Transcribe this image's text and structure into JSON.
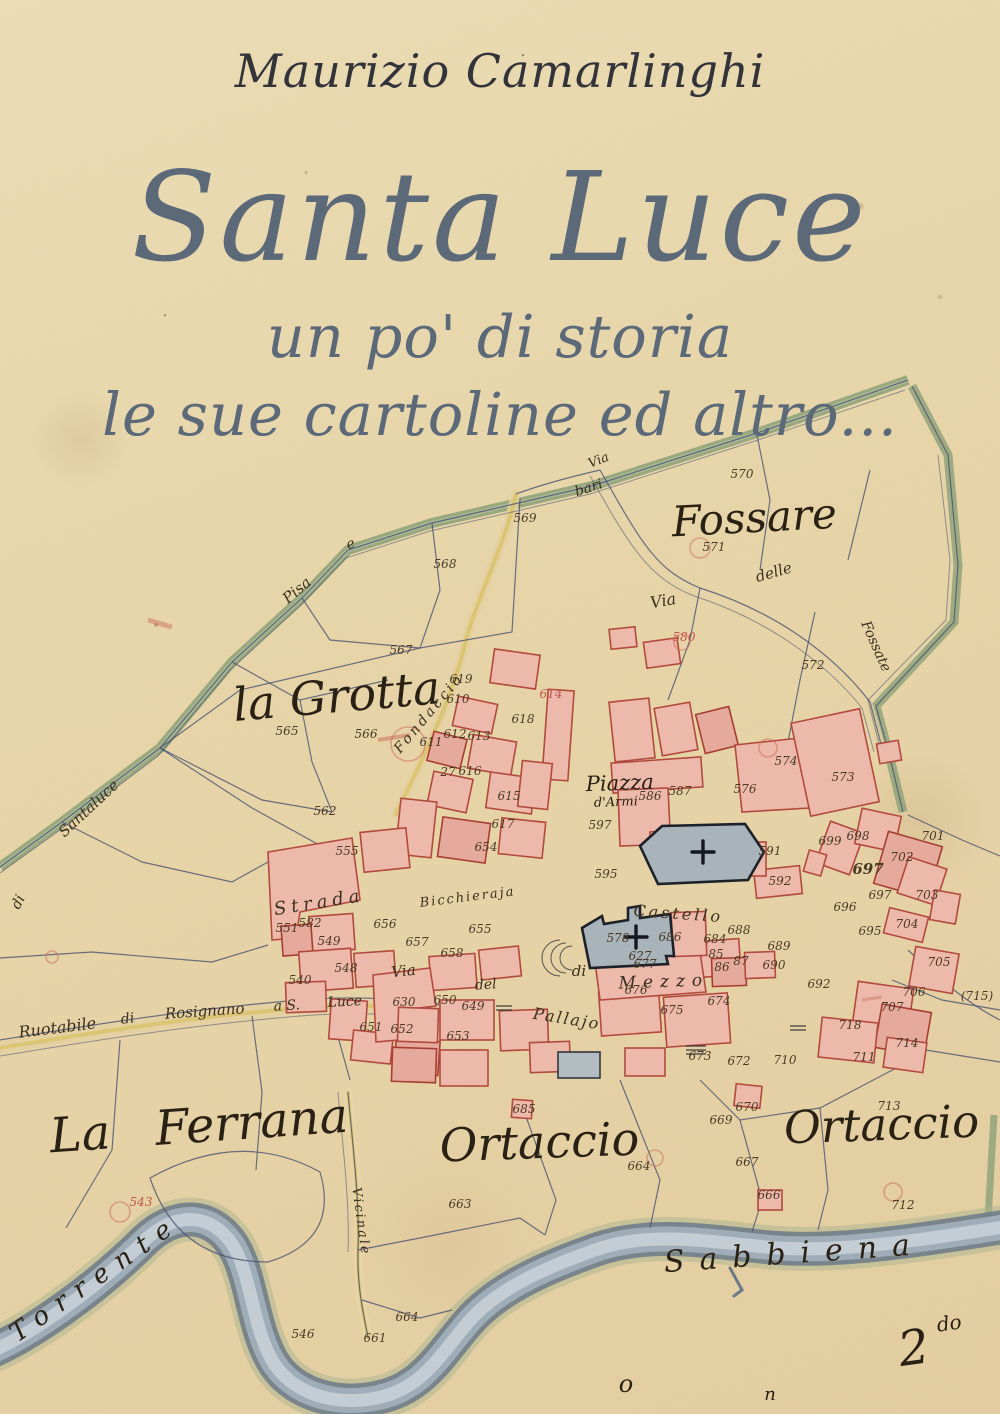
{
  "cover": {
    "author": "Maurizio Camarlinghi",
    "title": "Santa Luce",
    "subtitle1": "un po' di storia",
    "subtitle2": "le sue cartoline ed altro...",
    "colors": {
      "title_blue": "#5c6979",
      "author_ink": "#33343a",
      "paper": "#e9d7aa"
    }
  },
  "map": {
    "colors": {
      "ink_line": "#45506f",
      "building_fill": "#ecb9ab",
      "building_stroke": "#b24a3e",
      "church_fill": "#a9b3ba",
      "boundary_green": "#8ca078",
      "road_yellow": "#d9c267",
      "river_dark": "#6c7a88",
      "river_light": "#c6cfd4"
    },
    "region_labels": [
      {
        "name": "label-fossare",
        "text": "Fossare",
        "x": 755,
        "y": 532,
        "size": 42,
        "rot": -3
      },
      {
        "name": "label-la-grotta",
        "text": "la Grotta",
        "x": 338,
        "y": 712,
        "size": 46,
        "rot": -5
      },
      {
        "name": "label-la-ferrana",
        "text": "La Ferrana",
        "x": 200,
        "y": 1142,
        "size": 48,
        "rot": -4,
        "ws": 30
      },
      {
        "name": "label-ortaccio-west",
        "text": "Ortaccio",
        "x": 540,
        "y": 1158,
        "size": 46,
        "rot": -2
      },
      {
        "name": "label-ortaccio-east",
        "text": "Ortaccio",
        "x": 882,
        "y": 1140,
        "size": 45,
        "rot": -2
      },
      {
        "name": "label-river-sabbiena",
        "text": "Sabbiena",
        "x": 795,
        "y": 1263,
        "size": 30,
        "rot": -4,
        "ls": 15
      },
      {
        "name": "label-river-torrente",
        "text": "Torrente",
        "x": 100,
        "y": 1285,
        "size": 26,
        "rot": -35,
        "ls": 11
      },
      {
        "name": "label-piazza",
        "text": "Piazza",
        "x": 620,
        "y": 790,
        "size": 21,
        "rot": -2
      },
      {
        "name": "label-piazza-2",
        "text": "d'Armi",
        "x": 616,
        "y": 806,
        "size": 13,
        "rot": -2
      },
      {
        "name": "label-quarter-mark",
        "text": "2",
        "x": 916,
        "y": 1364,
        "size": 48,
        "rot": -8
      },
      {
        "name": "label-quarter-mark-sup",
        "text": "do",
        "x": 950,
        "y": 1330,
        "size": 20,
        "rot": -8
      },
      {
        "name": "label-mark-o",
        "text": "o",
        "x": 626,
        "y": 1392,
        "size": 24,
        "rot": 0
      },
      {
        "name": "label-mark-n",
        "text": "n",
        "x": 770,
        "y": 1400,
        "size": 18,
        "rot": 0
      }
    ],
    "street_labels": [
      {
        "name": "street-via-top",
        "text": "Via",
        "x": 600,
        "y": 464,
        "size": 13,
        "rot": -22
      },
      {
        "name": "street-bari",
        "text": "bari",
        "x": 590,
        "y": 492,
        "size": 14,
        "rot": -18
      },
      {
        "name": "street-e",
        "text": "e",
        "x": 352,
        "y": 548,
        "size": 14,
        "rot": -20
      },
      {
        "name": "street-pisa",
        "text": "Pisa",
        "x": 300,
        "y": 594,
        "size": 15,
        "rot": -40
      },
      {
        "name": "street-santaluce",
        "text": "Santaluce",
        "x": 92,
        "y": 812,
        "size": 15,
        "rot": -43
      },
      {
        "name": "street-di-left",
        "text": "di",
        "x": 22,
        "y": 904,
        "size": 14,
        "rot": -62
      },
      {
        "name": "street-via-ne",
        "text": "Via",
        "x": 664,
        "y": 606,
        "size": 16,
        "rot": -10
      },
      {
        "name": "street-delle",
        "text": "delle",
        "x": 775,
        "y": 577,
        "size": 15,
        "rot": -16
      },
      {
        "name": "street-fossate",
        "text": "Fossate",
        "x": 872,
        "y": 648,
        "size": 14,
        "rot": 66
      },
      {
        "name": "street-fondaccio",
        "text": "Fondaccio",
        "x": 432,
        "y": 716,
        "size": 14,
        "rot": -50,
        "ls": 3
      },
      {
        "name": "street-strada",
        "text": "Strada",
        "x": 320,
        "y": 908,
        "size": 18,
        "rot": -9,
        "ls": 5
      },
      {
        "name": "street-bicchieraja",
        "text": "Bicchieraja",
        "x": 468,
        "y": 901,
        "size": 13,
        "rot": -7,
        "ls": 2
      },
      {
        "name": "street-castello",
        "text": "Castello",
        "x": 678,
        "y": 919,
        "size": 16,
        "rot": 4,
        "ls": 3
      },
      {
        "name": "street-di-mezzo-1",
        "text": "di",
        "x": 579,
        "y": 976,
        "size": 15,
        "rot": 0
      },
      {
        "name": "street-di-mezzo-2",
        "text": "Mezzo",
        "x": 664,
        "y": 987,
        "size": 17,
        "rot": -2,
        "ls": 7
      },
      {
        "name": "street-via-pallajo-1",
        "text": "Via",
        "x": 404,
        "y": 976,
        "size": 15,
        "rot": -6
      },
      {
        "name": "street-via-pallajo-2",
        "text": "del",
        "x": 486,
        "y": 989,
        "size": 14,
        "rot": -4
      },
      {
        "name": "street-via-pallajo-3",
        "text": "Pallajo",
        "x": 566,
        "y": 1024,
        "size": 16,
        "rot": 9,
        "ls": 2
      },
      {
        "name": "street-ruotabile",
        "text": "Ruotabile",
        "x": 58,
        "y": 1033,
        "size": 16,
        "rot": -7
      },
      {
        "name": "street-ruotabile-di",
        "text": "di",
        "x": 128,
        "y": 1023,
        "size": 14,
        "rot": -6
      },
      {
        "name": "street-rosignano",
        "text": "Rosignano",
        "x": 205,
        "y": 1016,
        "size": 15,
        "rot": -4
      },
      {
        "name": "street-a-s",
        "text": "a S.",
        "x": 287,
        "y": 1010,
        "size": 14,
        "rot": -3
      },
      {
        "name": "street-luce",
        "text": "Luce",
        "x": 345,
        "y": 1006,
        "size": 14,
        "rot": -3
      },
      {
        "name": "street-vicinale",
        "text": "Vicinale",
        "x": 357,
        "y": 1222,
        "size": 13,
        "rot": 82,
        "ls": 2
      }
    ],
    "parcel_numbers": [
      {
        "n": "570",
        "x": 742,
        "y": 478
      },
      {
        "n": "571",
        "x": 714,
        "y": 551
      },
      {
        "n": "580",
        "x": 684,
        "y": 641,
        "red": true
      },
      {
        "n": "572",
        "x": 813,
        "y": 669
      },
      {
        "n": "573",
        "x": 843,
        "y": 781
      },
      {
        "n": "574",
        "x": 786,
        "y": 765
      },
      {
        "n": "565",
        "x": 287,
        "y": 735
      },
      {
        "n": "566",
        "x": 366,
        "y": 738
      },
      {
        "n": "567",
        "x": 401,
        "y": 654
      },
      {
        "n": "562",
        "x": 325,
        "y": 815
      },
      {
        "n": "568",
        "x": 445,
        "y": 568
      },
      {
        "n": "569",
        "x": 525,
        "y": 522
      },
      {
        "n": "543",
        "x": 141,
        "y": 1206,
        "red": true
      },
      {
        "n": "546",
        "x": 303,
        "y": 1338
      },
      {
        "n": "661",
        "x": 375,
        "y": 1342
      },
      {
        "n": "663",
        "x": 460,
        "y": 1208
      },
      {
        "n": "664",
        "x": 407,
        "y": 1321
      },
      {
        "n": "664",
        "x": 639,
        "y": 1170
      },
      {
        "n": "666",
        "x": 769,
        "y": 1199
      },
      {
        "n": "667",
        "x": 747,
        "y": 1166
      },
      {
        "n": "669",
        "x": 721,
        "y": 1124
      },
      {
        "n": "670",
        "x": 747,
        "y": 1111
      },
      {
        "n": "685",
        "x": 524,
        "y": 1113
      },
      {
        "n": "713",
        "x": 889,
        "y": 1110
      },
      {
        "n": "712",
        "x": 903,
        "y": 1209
      },
      {
        "n": "711",
        "x": 864,
        "y": 1061
      },
      {
        "n": "714",
        "x": 907,
        "y": 1047
      },
      {
        "n": "(715)",
        "x": 977,
        "y": 1000
      },
      {
        "n": "718",
        "x": 850,
        "y": 1029
      },
      {
        "n": "707",
        "x": 892,
        "y": 1011
      },
      {
        "n": "706",
        "x": 914,
        "y": 996
      },
      {
        "n": "705",
        "x": 939,
        "y": 966
      },
      {
        "n": "704",
        "x": 907,
        "y": 928
      },
      {
        "n": "695",
        "x": 870,
        "y": 935
      },
      {
        "n": "696",
        "x": 845,
        "y": 911
      },
      {
        "n": "703",
        "x": 927,
        "y": 899
      },
      {
        "n": "697",
        "x": 868,
        "y": 874,
        "b": true,
        "size": 15
      },
      {
        "n": "697",
        "x": 880,
        "y": 899
      },
      {
        "n": "698",
        "x": 858,
        "y": 840
      },
      {
        "n": "699",
        "x": 830,
        "y": 845
      },
      {
        "n": "701",
        "x": 933,
        "y": 840
      },
      {
        "n": "702",
        "x": 902,
        "y": 861
      },
      {
        "n": "692",
        "x": 819,
        "y": 988
      },
      {
        "n": "690",
        "x": 774,
        "y": 969
      },
      {
        "n": "689",
        "x": 779,
        "y": 950
      },
      {
        "n": "688",
        "x": 739,
        "y": 934
      },
      {
        "n": "684",
        "x": 715,
        "y": 943
      },
      {
        "n": "686",
        "x": 670,
        "y": 941
      },
      {
        "n": "677",
        "x": 645,
        "y": 968
      },
      {
        "n": "578",
        "x": 618,
        "y": 942
      },
      {
        "n": "676",
        "x": 636,
        "y": 994
      },
      {
        "n": "675",
        "x": 672,
        "y": 1014
      },
      {
        "n": "674",
        "x": 719,
        "y": 1005
      },
      {
        "n": "673",
        "x": 700,
        "y": 1060
      },
      {
        "n": "672",
        "x": 739,
        "y": 1065
      },
      {
        "n": "710",
        "x": 785,
        "y": 1064
      },
      {
        "n": "85",
        "x": 716,
        "y": 958
      },
      {
        "n": "86",
        "x": 722,
        "y": 971
      },
      {
        "n": "87",
        "x": 741,
        "y": 965
      },
      {
        "n": "592",
        "x": 780,
        "y": 885
      },
      {
        "n": "595",
        "x": 606,
        "y": 878
      },
      {
        "n": "597",
        "x": 600,
        "y": 829
      },
      {
        "n": "587",
        "x": 680,
        "y": 795
      },
      {
        "n": "586",
        "x": 650,
        "y": 800
      },
      {
        "n": "576",
        "x": 745,
        "y": 793
      },
      {
        "n": "591",
        "x": 770,
        "y": 855
      },
      {
        "n": "555",
        "x": 347,
        "y": 855
      },
      {
        "n": "582",
        "x": 310,
        "y": 927
      },
      {
        "n": "551",
        "x": 287,
        "y": 932
      },
      {
        "n": "549",
        "x": 329,
        "y": 945
      },
      {
        "n": "548",
        "x": 346,
        "y": 972
      },
      {
        "n": "540",
        "x": 300,
        "y": 984
      },
      {
        "n": "630",
        "x": 404,
        "y": 1006
      },
      {
        "n": "650",
        "x": 445,
        "y": 1004
      },
      {
        "n": "649",
        "x": 473,
        "y": 1010
      },
      {
        "n": "651",
        "x": 371,
        "y": 1031
      },
      {
        "n": "652",
        "x": 402,
        "y": 1033
      },
      {
        "n": "653",
        "x": 458,
        "y": 1040
      },
      {
        "n": "654",
        "x": 486,
        "y": 851
      },
      {
        "n": "655",
        "x": 480,
        "y": 933
      },
      {
        "n": "656",
        "x": 385,
        "y": 928
      },
      {
        "n": "657",
        "x": 417,
        "y": 946
      },
      {
        "n": "658",
        "x": 452,
        "y": 957
      },
      {
        "n": "610",
        "x": 458,
        "y": 703
      },
      {
        "n": "611",
        "x": 431,
        "y": 746
      },
      {
        "n": "612",
        "x": 455,
        "y": 738
      },
      {
        "n": "613",
        "x": 479,
        "y": 740
      },
      {
        "n": "614",
        "x": 551,
        "y": 698,
        "red": true
      },
      {
        "n": "615",
        "x": 509,
        "y": 800
      },
      {
        "n": "616",
        "x": 470,
        "y": 775
      },
      {
        "n": "617",
        "x": 503,
        "y": 828
      },
      {
        "n": "618",
        "x": 523,
        "y": 723
      },
      {
        "n": "619",
        "x": 461,
        "y": 683
      },
      {
        "n": "627",
        "x": 640,
        "y": 960
      },
      {
        "n": "27",
        "x": 448,
        "y": 776
      }
    ]
  }
}
